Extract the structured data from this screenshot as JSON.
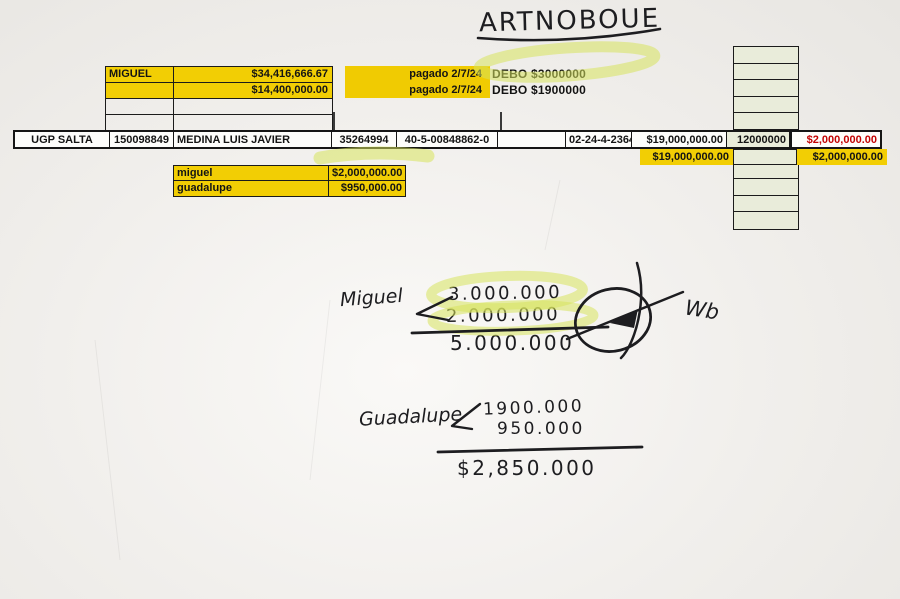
{
  "handwriting": {
    "title": "ARTNOBOUE",
    "miguel_calc": {
      "name": "Miguel",
      "addend1": "3.000.000",
      "addend2": "2.000.000",
      "total": "5.000.000",
      "initials": "Wb"
    },
    "guadalupe_calc": {
      "name": "Guadalupe",
      "addend1": "1900.000",
      "addend2": "950.000",
      "total": "$2,850.000"
    }
  },
  "top_table": {
    "rows": [
      {
        "label": "MIGUEL",
        "amount": "$34,416,666.67"
      },
      {
        "label": "",
        "amount": "$14,400,000.00"
      },
      {
        "label": "",
        "amount": ""
      },
      {
        "label": "",
        "amount": ""
      }
    ],
    "paid_notes": [
      "pagado 2/7/24",
      "pagado 2/7/24"
    ],
    "debt_notes": [
      "DEBO $3000000",
      "DEBO $1900000"
    ]
  },
  "ledger_row": {
    "office": "UGP SALTA",
    "file_number": "150098849",
    "person_name": "MEDINA LUIS JAVIER",
    "document_number": "35264994",
    "account_number": "40-5-00848862-0",
    "blank": "",
    "code": "02-24-4-2364",
    "amount": "$19,000,000.00",
    "figure": "12000000",
    "amount_red": "$2,000,000.00"
  },
  "subtotal_row": {
    "amount": "$19,000,000.00",
    "amount_right": "$2,000,000.00"
  },
  "mini_table": {
    "rows": [
      {
        "name": "miguel",
        "amount": "$2,000,000.00"
      },
      {
        "name": "guadalupe",
        "amount": "$950,000.00"
      }
    ]
  },
  "colors": {
    "highlight_yellow": "#f2ce04",
    "band_yellow": "#f0cb02",
    "sage_cell": "#e9ecda",
    "red_amount": "#c40404",
    "marker_green": "#d7e35c",
    "ink": "#1d1d20"
  }
}
